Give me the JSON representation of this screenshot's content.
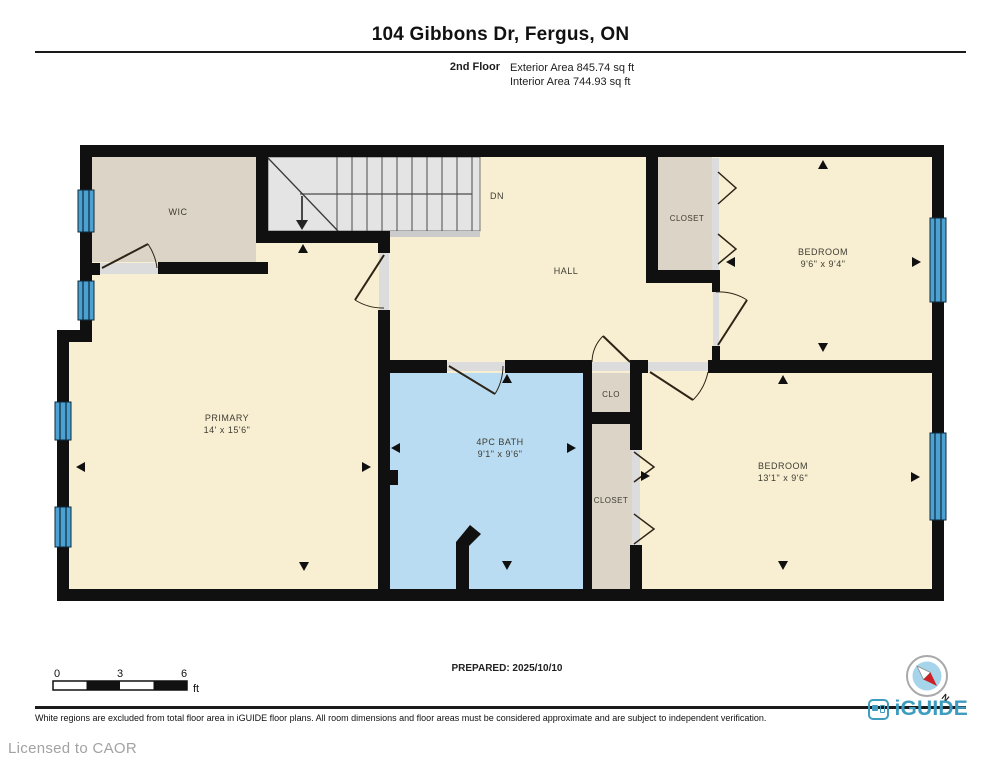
{
  "header": {
    "title": "104 Gibbons Dr, Fergus, ON",
    "floor_label": "2nd Floor",
    "exterior_area": "Exterior Area 845.74 sq ft",
    "interior_area": "Interior Area 744.93 sq ft"
  },
  "rooms": {
    "wic": {
      "label": "WIC"
    },
    "hall": {
      "label": "HALL"
    },
    "closet_top": {
      "label": "CLOSET"
    },
    "bedroom_top": {
      "label": "BEDROOM",
      "dims": "9'6\" x 9'4\""
    },
    "primary": {
      "label": "PRIMARY",
      "dims": "14' x 15'6\""
    },
    "bath": {
      "label": "4PC BATH",
      "dims": "9'1\" x 9'6\""
    },
    "clo": {
      "label": "CLO"
    },
    "closet_mid": {
      "label": "CLOSET"
    },
    "bedroom_bottom": {
      "label": "BEDROOM",
      "dims": "13'1\" x 9'6\""
    }
  },
  "stairs": {
    "label": "DN"
  },
  "scale_bar": {
    "t0": "0",
    "t3": "3",
    "t6": "6",
    "unit": "ft"
  },
  "prepared": "PREPARED: 2025/10/10",
  "compass": {
    "north": "N"
  },
  "footer": {
    "disclaimer": "White regions are excluded from total floor area in iGUIDE floor plans. All room dimensions and floor areas must be considered approximate and are subject to independent verification.",
    "brand": "iGUIDE",
    "licensed": "Licensed to CAOR"
  },
  "colors": {
    "wall": "#101010",
    "room_cream": "#f8efd3",
    "room_taupe": "#dcd4c6",
    "bath_blue": "#badcf2",
    "stair_gray": "#e4e4e4",
    "window_blue": "#4aa1d2",
    "brand_teal": "#3e9dbf",
    "compass_red": "#cc2127"
  }
}
